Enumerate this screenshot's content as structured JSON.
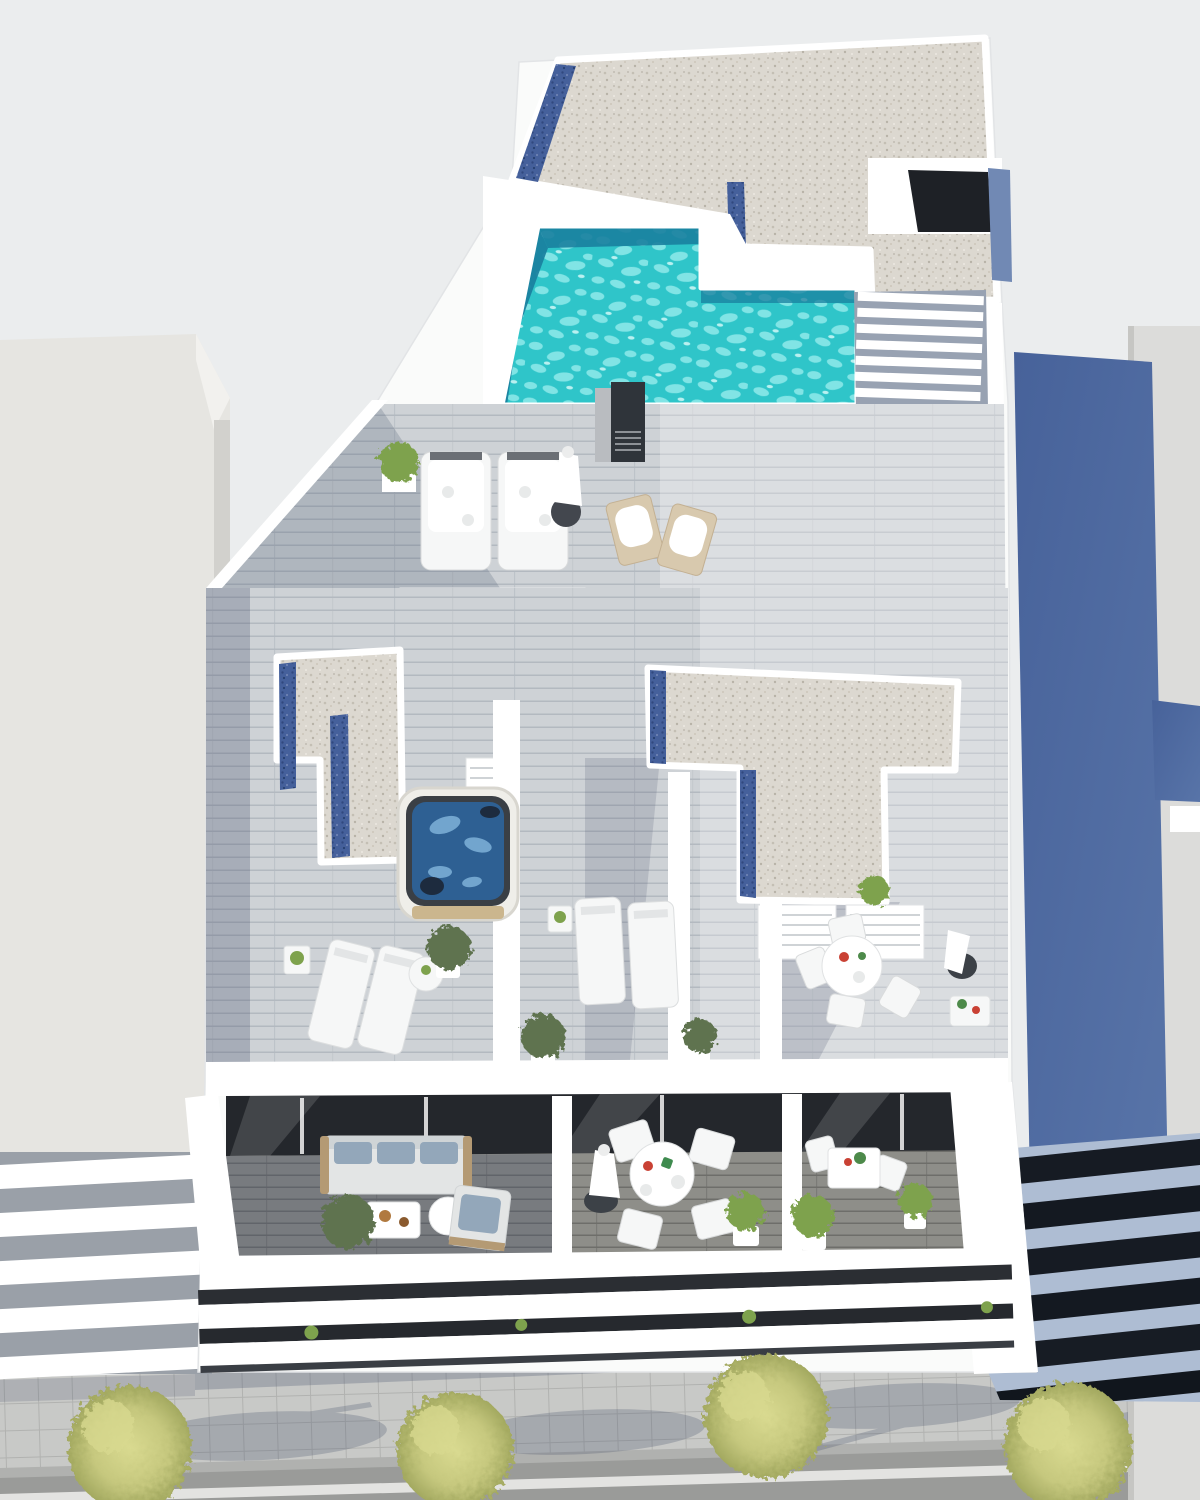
{
  "meta": {
    "title": "Aerial 3D architectural rendering of a white apartment building with rooftop pool, terraces and street below",
    "visible_text": "none"
  },
  "palette": {
    "bg": "#ebedee",
    "white_wall": "#fafbfa",
    "white_bright": "#ffffff",
    "wall_shade": "#d9dde2",
    "left_building": "#e6e5e1",
    "right_building": "#dcdcda",
    "blue_wall": "#5874a8",
    "blue_wall_dark": "#47629a",
    "gravel": "#dcd8d0",
    "gravel_dot": "#c4bfb4",
    "gravel_blue": "#45609b",
    "gravel_blue_dark": "#31497f",
    "pool": "#2fc5c9",
    "pool_light": "#8feaea",
    "pool_dark": "#1a7f9e",
    "deck": "#ced2d6",
    "deck_shadow": "#98a2b2",
    "plank_line": "#b3b9c0",
    "balcony_floor": "#8e8e89",
    "balcony_floor_shade": "#62666b",
    "glass": "#24272c",
    "furniture_white": "#f6f7f7",
    "cushion": "#93a7ba",
    "wood": "#d8c9ae",
    "wood_dark": "#b49a74",
    "plant": "#5f7350",
    "plant_bright": "#7ea24d",
    "tree": "#c6c87e",
    "tree_dark": "#a3a960",
    "jacuzzi_water": "#2e6093",
    "jacuzzi_light": "#7fb2d9",
    "chimney": "#2f343a",
    "sidewalk": "#c8c9c7",
    "sidewalk_line": "#b1b2b0",
    "road": "#9a9b99",
    "road_line": "#e9e9e7",
    "shadow": "#46506a"
  },
  "scene": {
    "view": "top-down aerial, sun from upper left, shadows cast right/down",
    "street": {
      "trees": 4,
      "lane_marking": "single white line",
      "sidewalk": "square paving tiles"
    },
    "buildings": {
      "left_neighbor": "plain light-gray block",
      "right_neighbor": "light-gray block with blue party wall and dark diagonal louvered facade",
      "main": "white multi-level apartment building"
    },
    "rooftop": {
      "pool": {
        "shape": "L-shaped",
        "water": "turquoise with ripple highlights"
      },
      "gravel_roof_sections": 3,
      "blue_pebble_strips": 6,
      "stair_steps": 7,
      "chimney": 1,
      "stair_bulkhead_door": 1
    },
    "furniture_inventory": {
      "upholstered_sun_loungers": 2,
      "flat_sun_loungers": 7,
      "wooden_deck_chairs": 2,
      "parasols": 3,
      "jacuzzi": 1,
      "round_dining_tables": 2,
      "dining_chairs": 8,
      "bistro_tables": 2,
      "sofa": 1,
      "armchair": 1,
      "coffee_tables": 2,
      "side_tables": 5,
      "planters_and_shrubs": 12
    }
  }
}
